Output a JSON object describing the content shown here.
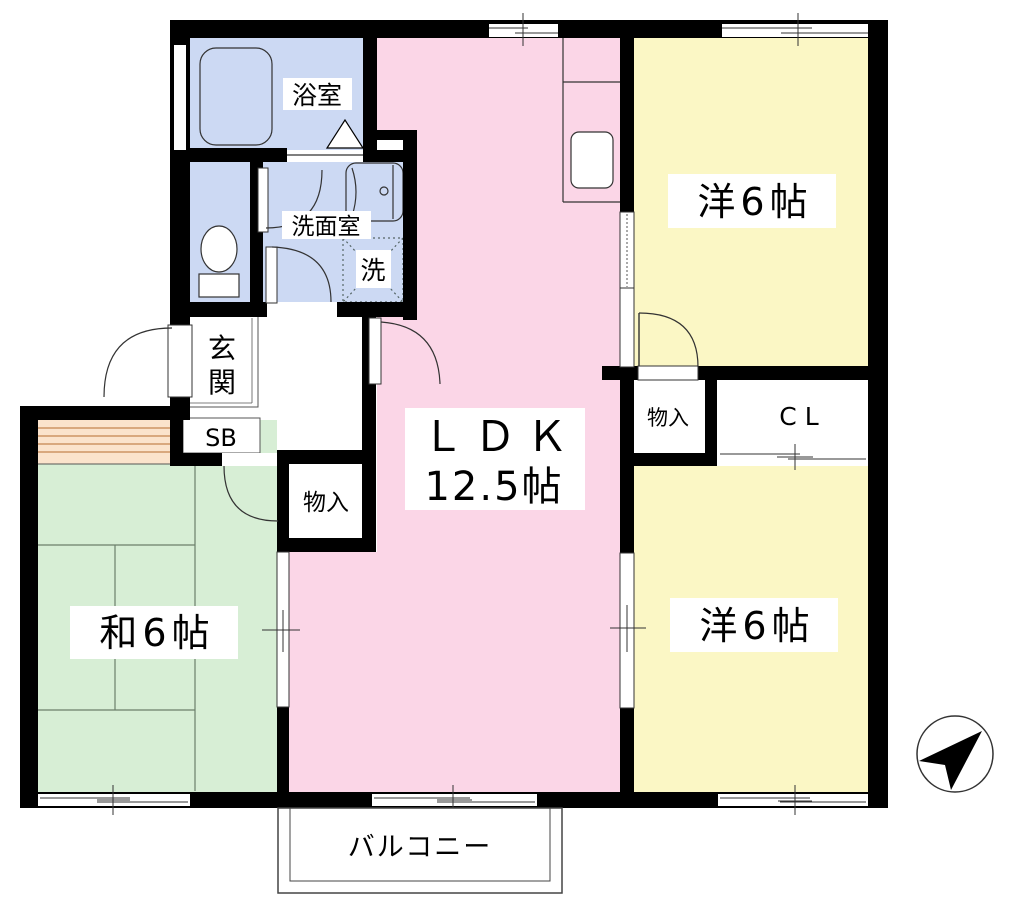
{
  "colors": {
    "wall": "#000000",
    "ldk_pink": "#fbd6e7",
    "western_yellow": "#fbf7c5",
    "japanese_green": "#d7eed5",
    "wet_area_blue": "#ccd9f3",
    "closet_orange": "#fbe3cc",
    "closet_stripe": "#d9a87e",
    "line": "#333333"
  },
  "rooms": {
    "bath": {
      "label": "浴室"
    },
    "washroom": {
      "label": "洗面室"
    },
    "laundry": {
      "label": "洗"
    },
    "entrance": {
      "label": "玄関",
      "label_char1": "玄",
      "label_char2": "関"
    },
    "shoe_box": {
      "label": "SB"
    },
    "hall_storage": {
      "label": "物入"
    },
    "ldk": {
      "name": "ＬＤＫ",
      "size": "12.5帖"
    },
    "western_top": {
      "label": "洋6帖"
    },
    "right_storage": {
      "label": "物入"
    },
    "closet": {
      "label": "CL"
    },
    "western_bottom": {
      "label": "洋6帖"
    },
    "japanese": {
      "label": "和6帖"
    },
    "balcony": {
      "label": "バルコニー"
    }
  },
  "compass": {
    "icon": "north-arrow-icon"
  }
}
